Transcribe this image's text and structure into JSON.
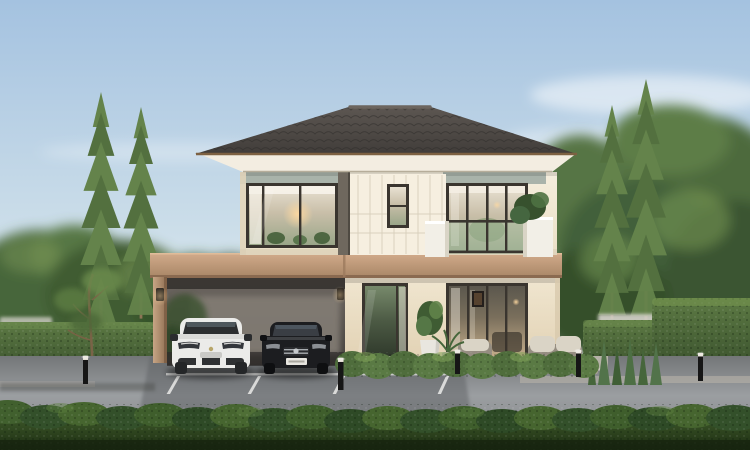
{
  "meta": {
    "type": "architectural-exterior-render",
    "description": "Photorealistic rendering of a modern two-story house with hip roof, attached carport sheltering a white SUV and a black sedan, glass balcony, manicured hedges, pine trees and an asphalt road in the foreground"
  },
  "palette": {
    "sky_top": "#a4c2e0",
    "sky_mid": "#cfe0ea",
    "sky_horizon": "#eef1f0",
    "cloud_white": "#ffffff",
    "canopy_dark": "#35502c",
    "canopy_mid": "#47663a",
    "canopy_light": "#7f9f58",
    "pine_green": "#64834b",
    "pine_green_dark": "#53703f",
    "tree_trunk": "#8d7456",
    "hedge_top": "#5d7a44",
    "hedge_base": "#2f4526",
    "foreground_hedge_top": "#3c5628",
    "foreground_hedge_base": "#1c2c12",
    "roof_dark": "#413d3a",
    "roof_light": "#5d5752",
    "roof_trim": "#7d6142",
    "fascia_cream": "#f3ede1",
    "band_green_gray": "#a9b3aa",
    "wall_cream": "#f3ecdb",
    "panel_line": "#d9d1be",
    "pilaster_dark": "#6f685e",
    "frame_dark": "#3a352f",
    "glass_warm": "#c9bfa9",
    "glass_green": "#8fa583",
    "lamp_glow": "#ffd9a0",
    "band_tan_light": "#d2ab8b",
    "band_tan_dark": "#a98767",
    "band_edge": "#8a6a50",
    "carport_top": "#6e6862",
    "carport_bottom": "#423e3a",
    "carport_backwall": "#837d74",
    "road_dark": "#737678",
    "road_light": "#9b9ea1",
    "driveway": "#5f6265",
    "kerb": "#b7b3a8",
    "line_white": "#f2f2f0",
    "patio": "#b5b1a7",
    "car_white": "#ebebe9",
    "car_glass": "#2c2e30",
    "car_black": "#1c1d20",
    "chrome": "#a8acb0",
    "plate_white": "#e8e6e0",
    "wicker": "#958d81",
    "cushion": "#dad4c6",
    "wood_table": "#b4a78f",
    "pot_white": "#e9e6df",
    "bollard": "#161616",
    "bollard_cap": "#e4dfd4",
    "wall_behind": "#d6d3cb",
    "tree_trunk_dark": "#6e5a43"
  },
  "scene": {
    "environment": {
      "sky": "clear blue sky with thin wispy clouds",
      "lighting": "soft warm daylight"
    },
    "background": {
      "broadleaf_canopy": [
        "left of house",
        "right of house"
      ],
      "pine_trees_left": 2,
      "pine_trees_right": 2
    },
    "house": {
      "stories": 2,
      "roof": {
        "type": "hip",
        "material": "dark tile"
      },
      "second_floor": [
        "corner picture window with warm interior light",
        "paneled wall with tall narrow window",
        "sliding glass doors",
        "balcony with glass railing and white parapets",
        "balcony corner plant"
      ],
      "floor_band": "tan horizontal band between floors continuing into carport beam",
      "ground_floor": [
        "glass entrance door",
        "white planter with shrub",
        "wide sliding glass doors with curtains",
        "patio terrace with step"
      ],
      "carport": {
        "attached": true,
        "visible_posts": 1,
        "wall_lamps": 2
      }
    },
    "vehicles": [
      {
        "label": "white-suv",
        "position": "carport left stall"
      },
      {
        "label": "black-sedan",
        "position": "carport right stall",
        "license_plate": "visible but illegible"
      }
    ],
    "landscaping": {
      "hedge_walls": [
        "tall left boundary hedge",
        "mid-height right hedge",
        "large right corner hedge"
      ],
      "white_boundary_wall_caps": true,
      "front_trimmed_hedge_row": true,
      "ornamental_grasses": "right of patio",
      "small_deciduous_tree": "in front of left hedge",
      "bollard_path_lights": 5
    },
    "outdoor_furniture": [
      "wicker armchair",
      "low coffee table",
      "wicker sofa with light cushions",
      "side table"
    ],
    "foreground": {
      "road": "asphalt street",
      "markings": "white parking stall lines",
      "hedge_strip": "dark trimmed hedge along bottom edge"
    }
  }
}
